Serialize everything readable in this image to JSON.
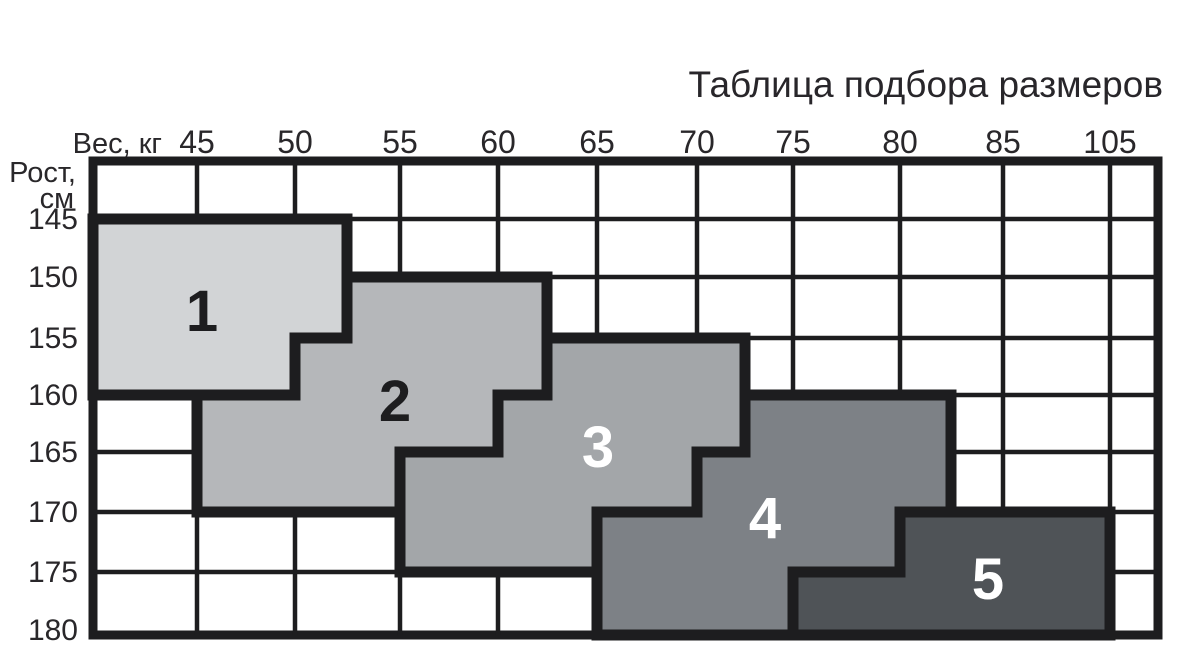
{
  "title": "Таблица подбора размеров",
  "axes": {
    "weight": {
      "label": "Вес, кг",
      "ticks": [
        "45",
        "50",
        "55",
        "60",
        "65",
        "70",
        "75",
        "80",
        "85",
        "105"
      ]
    },
    "height": {
      "label_line1": "Рост,",
      "label_line2": "см",
      "ticks": [
        "145",
        "150",
        "155",
        "160",
        "165",
        "170",
        "175",
        "180"
      ]
    }
  },
  "regions": [
    {
      "label": "1",
      "color": "#d2d4d6",
      "text_color": "#1d1d1f"
    },
    {
      "label": "2",
      "color": "#b5b7ba",
      "text_color": "#1d1d1f"
    },
    {
      "label": "3",
      "color": "#a3a6a9",
      "text_color": "#ffffff"
    },
    {
      "label": "4",
      "color": "#7d8186",
      "text_color": "#ffffff"
    },
    {
      "label": "5",
      "color": "#4f5357",
      "text_color": "#ffffff"
    }
  ],
  "colors": {
    "background": "#ffffff",
    "grid": "#1d1d1f",
    "text": "#29272a"
  },
  "chart_data": {
    "type": "area",
    "title": "Таблица подбора размеров",
    "xlabel": "Вес, кг",
    "ylabel": "Рост, см",
    "x_ticks": [
      45,
      50,
      55,
      60,
      65,
      70,
      75,
      80,
      85,
      105
    ],
    "y_ticks": [
      145,
      150,
      155,
      160,
      165,
      170,
      175,
      180
    ],
    "axis_notes": "Ticks sit on grid lines; leftmost column edge (~40 кг) and top row edge (~140 см) are unlabeled; a narrow extra column follows the 105 line; height increases downward.",
    "grid": true,
    "legend": "none",
    "series": [
      {
        "name": "Size 1",
        "polygon_weight_height": [
          [
            40,
            145
          ],
          [
            52.5,
            145
          ],
          [
            52.5,
            155
          ],
          [
            50,
            155
          ],
          [
            50,
            160
          ],
          [
            40,
            160
          ]
        ]
      },
      {
        "name": "Size 2",
        "polygon_weight_height": [
          [
            52.5,
            150
          ],
          [
            62.5,
            150
          ],
          [
            62.5,
            160
          ],
          [
            60,
            160
          ],
          [
            60,
            165
          ],
          [
            55,
            165
          ],
          [
            55,
            170
          ],
          [
            45,
            170
          ],
          [
            45,
            160
          ],
          [
            50,
            160
          ],
          [
            50,
            155
          ],
          [
            52.5,
            155
          ]
        ]
      },
      {
        "name": "Size 3",
        "polygon_weight_height": [
          [
            62.5,
            155
          ],
          [
            72.5,
            155
          ],
          [
            72.5,
            165
          ],
          [
            70,
            165
          ],
          [
            70,
            170
          ],
          [
            65,
            170
          ],
          [
            65,
            175
          ],
          [
            55,
            175
          ],
          [
            55,
            165
          ],
          [
            60,
            165
          ],
          [
            60,
            160
          ],
          [
            62.5,
            160
          ]
        ]
      },
      {
        "name": "Size 4",
        "polygon_weight_height": [
          [
            72.5,
            160
          ],
          [
            82.5,
            160
          ],
          [
            82.5,
            170
          ],
          [
            80,
            170
          ],
          [
            80,
            175
          ],
          [
            75,
            175
          ],
          [
            75,
            180
          ],
          [
            65,
            180
          ],
          [
            65,
            170
          ],
          [
            70,
            170
          ],
          [
            70,
            165
          ],
          [
            72.5,
            165
          ]
        ]
      },
      {
        "name": "Size 5",
        "polygon_weight_height": [
          [
            80,
            170
          ],
          [
            105,
            170
          ],
          [
            105,
            180
          ],
          [
            75,
            180
          ],
          [
            75,
            175
          ],
          [
            80,
            175
          ]
        ]
      }
    ]
  }
}
